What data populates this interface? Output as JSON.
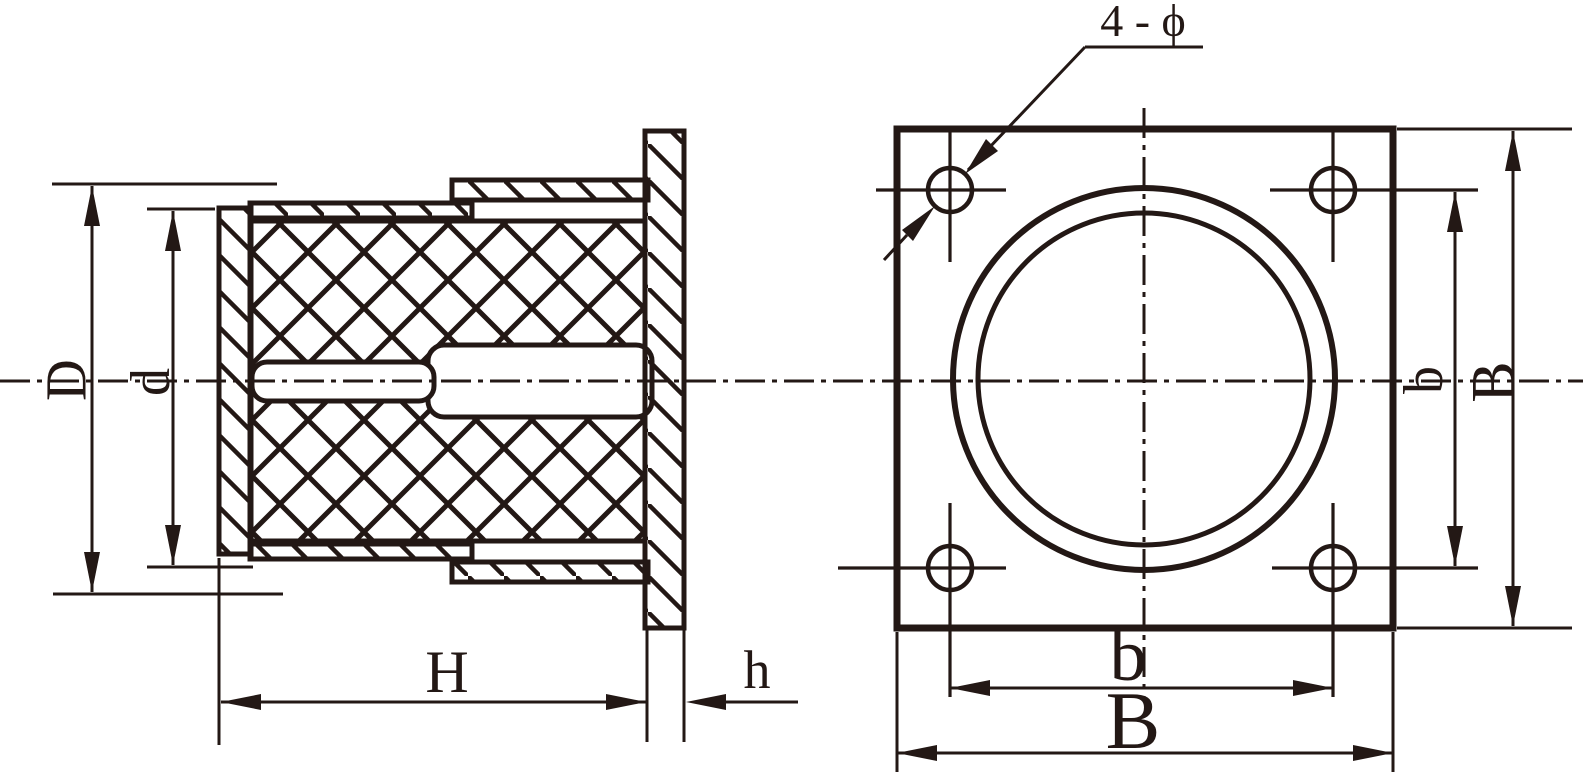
{
  "drawing": {
    "ink_color": "#231815",
    "paper_color": "#ffffff",
    "side_view": {
      "dim_outer_diameter": "D",
      "dim_inner_diameter": "d",
      "dim_total_height": "H",
      "dim_flange_thickness": "h"
    },
    "front_view": {
      "hole_callout": "4 - ϕ",
      "dim_hole_spacing_bottom": "b",
      "dim_plate_width_bottom": "B",
      "dim_hole_spacing_right": "b",
      "dim_plate_width_right": "B"
    }
  }
}
